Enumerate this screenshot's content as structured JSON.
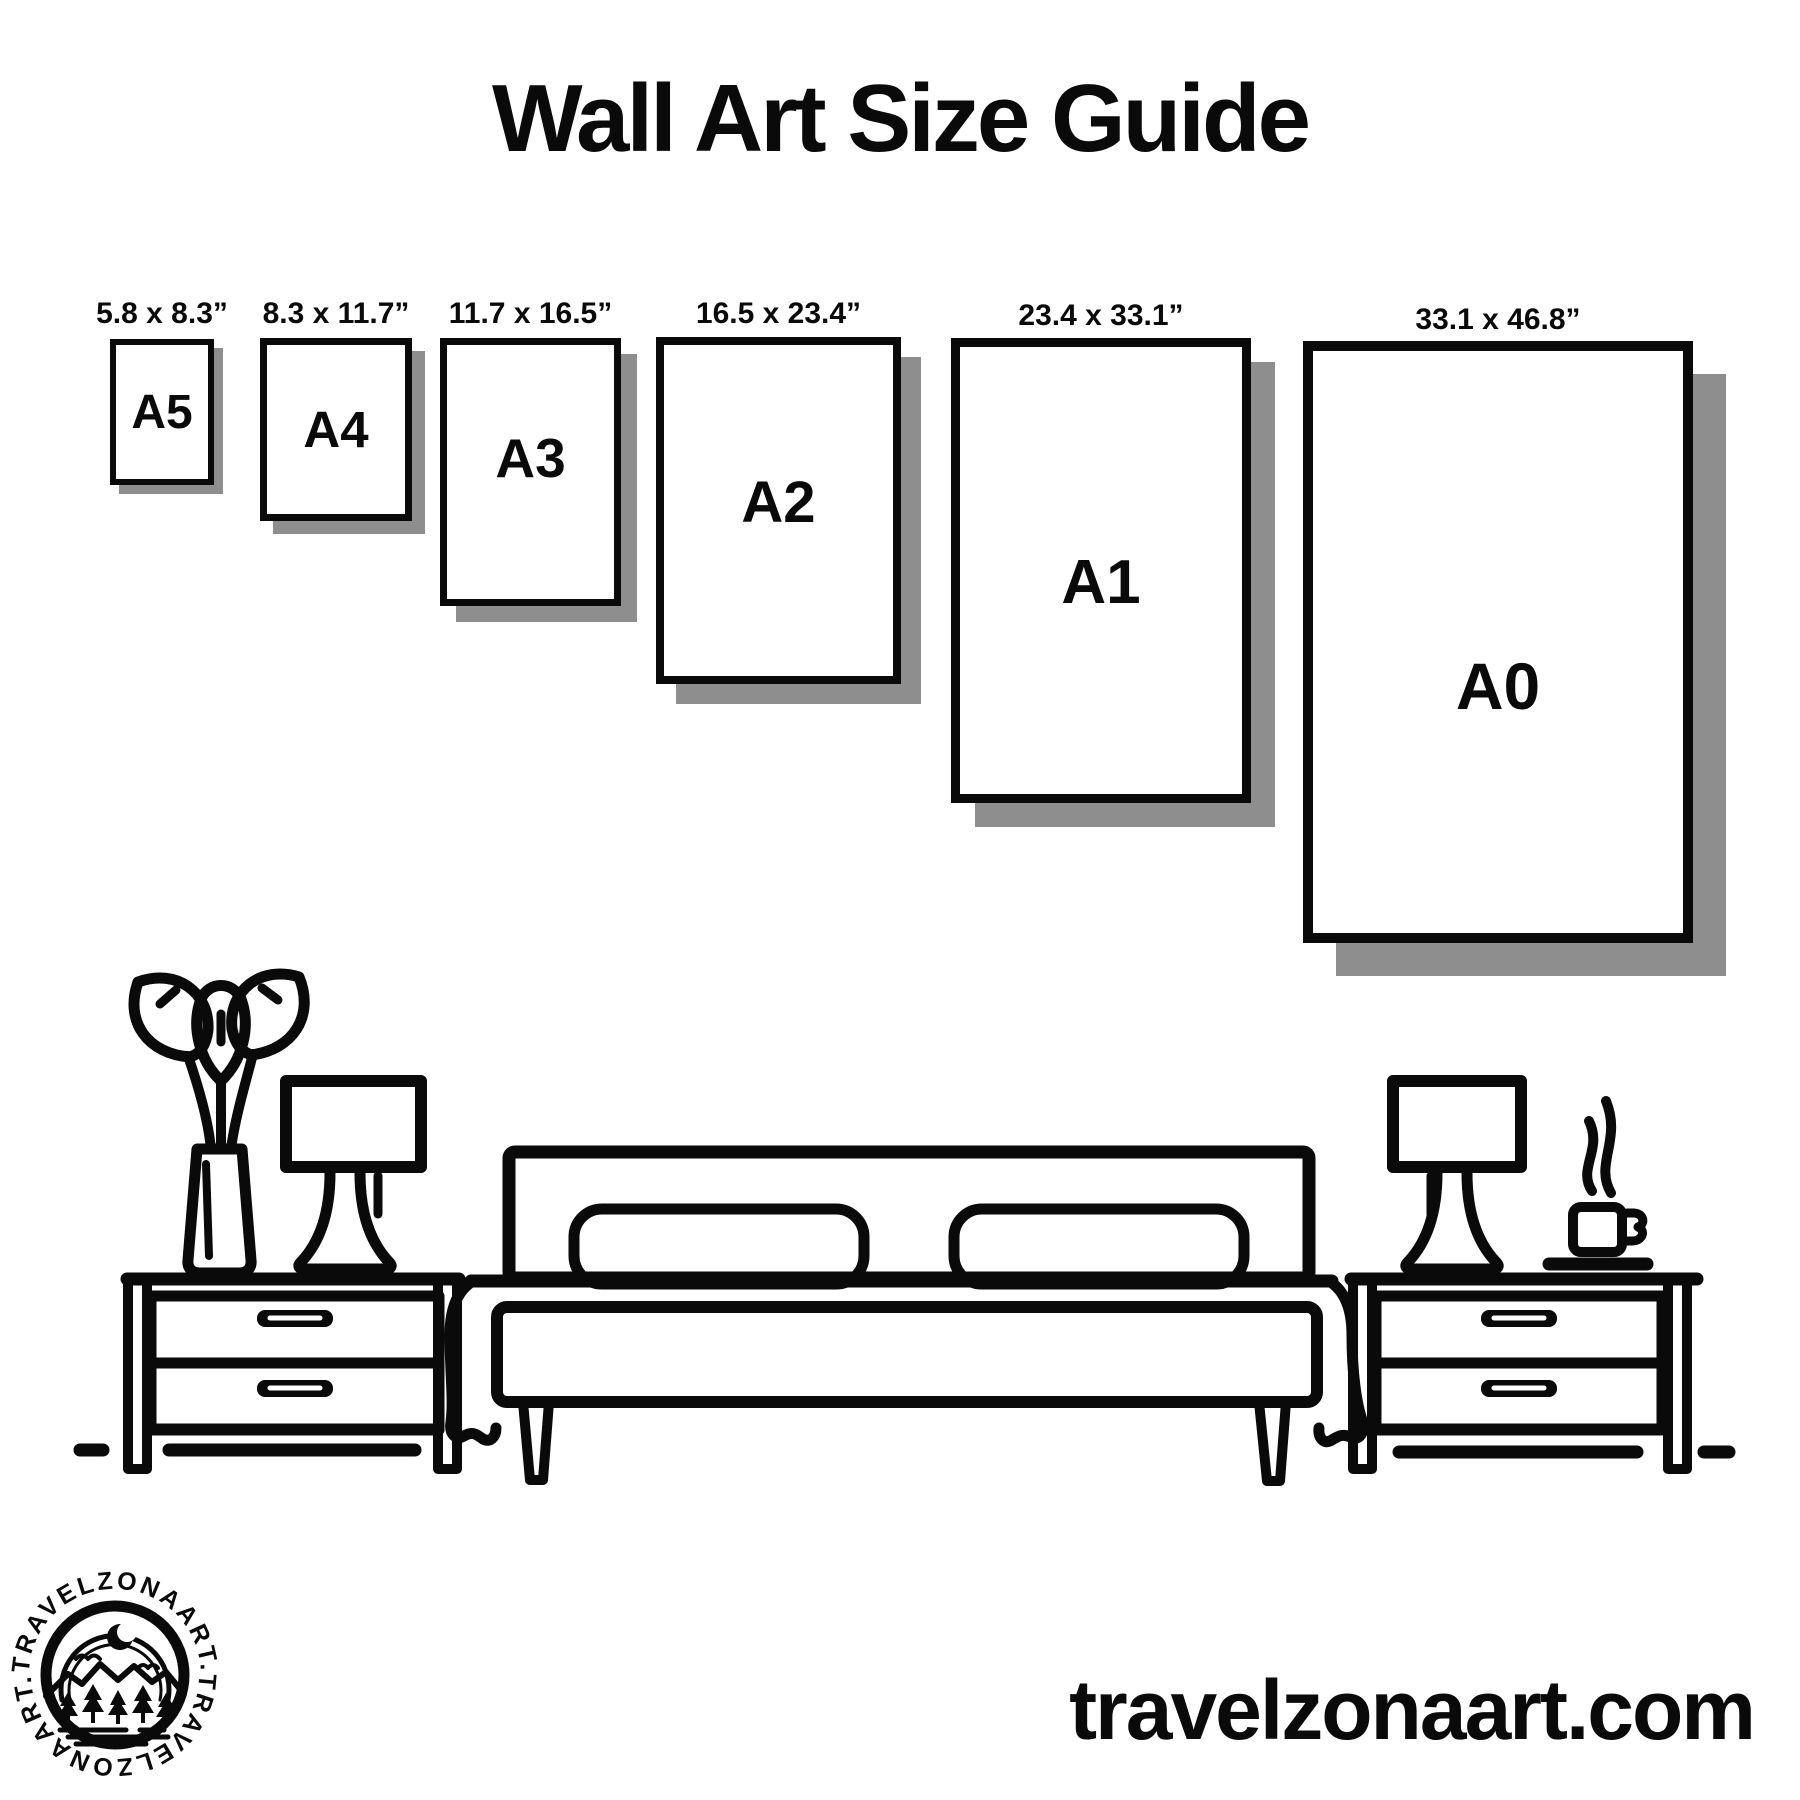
{
  "title": "Wall Art Size Guide",
  "frames": [
    {
      "name": "A5",
      "size_label": "5.8 x 8.3”"
    },
    {
      "name": "A4",
      "size_label": "8.3 x 11.7”"
    },
    {
      "name": "A3",
      "size_label": "11.7 x 16.5”"
    },
    {
      "name": "A2",
      "size_label": "16.5 x 23.4”"
    },
    {
      "name": "A1",
      "size_label": "23.4 x 33.1”"
    },
    {
      "name": "A0",
      "size_label": "33.1 x 46.8”"
    }
  ],
  "logo": {
    "brand_text_top": "TRAVELZONAART.",
    "brand_text_bottom": "TRAVELZONAART."
  },
  "footer": {
    "website": "travelzonaart.com"
  },
  "colors": {
    "ink": "#0a0a0a",
    "shadow": "#8e8e8e",
    "background": "#ffffff"
  }
}
